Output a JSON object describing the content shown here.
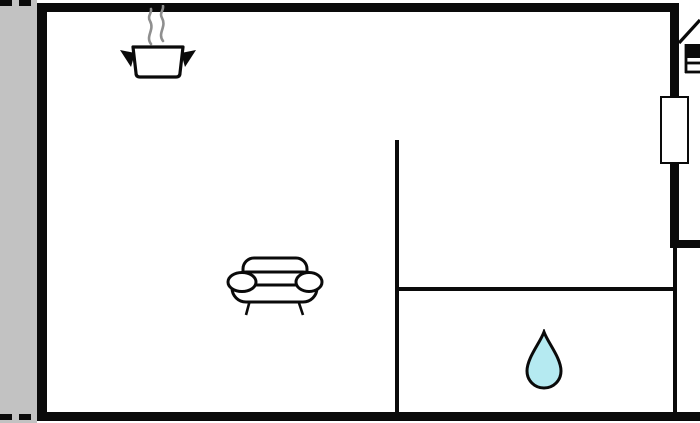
{
  "document": {
    "kind": "holiday-home floor plan drawing",
    "visible_text": ""
  },
  "colors": {
    "wall": "#0a0a0a",
    "terrace_fill": "#c2c2c2",
    "room_fill": "#ffffff",
    "water_drop_fill": "#b5eaf1",
    "steam_stroke": "#8f8f8f"
  },
  "icons": [
    {
      "name": "cooking-pot-icon",
      "meaning": "kitchen / cooking area"
    },
    {
      "name": "sofa-icon",
      "meaning": "living / seating area"
    },
    {
      "name": "water-drop-icon",
      "meaning": "bathroom / water"
    },
    {
      "name": "bed-icon",
      "meaning": "bedroom, partially cut off at right edge"
    }
  ],
  "structure": {
    "terrace": "gray strip with dashed open edges along the left side",
    "window": "white window/door symbol on upper right wall",
    "interior_walls": "one vertical partition with door opening at top, one horizontal partition on the right half",
    "note": "building continues past the right edge of the image"
  }
}
